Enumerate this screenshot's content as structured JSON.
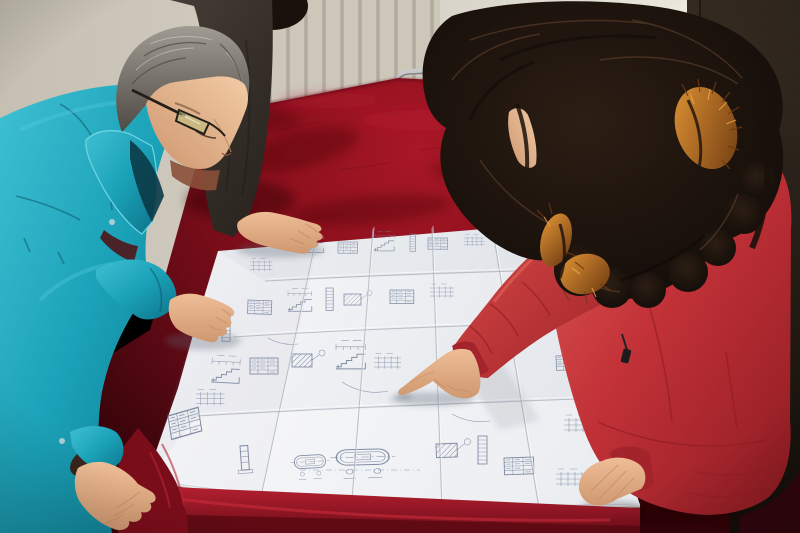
{
  "meta": {
    "type": "photograph",
    "description": "Three people lean over a large folded engineering blueprint spread on a table draped with worn dark-red velvet. A middle-aged man with gray hair and dark-rimmed glasses in a teal work jacket studies the drawing with both hands on it; a colleague in a dark jacket rests one hand on the sheet; a woman with long dark wavy hair, wearing a red hooded down coat with orange fur trim, points at a detail with her right index finger.",
    "setting": "indoor room with aged off-white wall, vertical-fin radiator, chrome tube chair behind the table and a dark doorway at the right edge"
  },
  "people": [
    {
      "id": "worker-teal",
      "position": "left",
      "appearance": "middle-aged man, gray hair, dark-rimmed glasses",
      "clothing": "teal work jacket with snap buttons and tall collar",
      "action": "leaning over the drawing, right hand on the sheet, left hand on the table corner"
    },
    {
      "id": "colleague-dark",
      "position": "upper-left background, mostly hidden",
      "appearance": "black hair, only head top and arm visible",
      "clothing": "dark brown-gray jacket",
      "action": "hand resting on the top edge of the drawing"
    },
    {
      "id": "woman-red",
      "position": "right, seen from behind-above",
      "appearance": "long dark wavy hair, sliver of face profile visible",
      "clothing": "red hooded down parka with orange fur-trimmed hood and black zipper pull",
      "action": "pointing at the blueprint with right index finger, left hand resting on the sheet"
    }
  ],
  "objects": {
    "blueprint": {
      "kind": "large folded technical drawing sheet",
      "paper_color": "white",
      "line_color": "blue-gray",
      "content": "stair section details, dimension chains, data tables, slotted flange details, ladder strips, hatched details, leader balloons; annotations too small to read",
      "folds": "grid of vertical and horizontal creases from being folded"
    },
    "table": {
      "covering": "dark red velvet cloth",
      "condition": "worn and mottled, bright fold along front edge, draped corner at lower left"
    },
    "chair": {
      "kind": "metal tube frame chair",
      "finish": "chrome",
      "location": "behind the table, partly hidden"
    },
    "radiator": {
      "kind": "vertical-fin wall radiator",
      "location": "upper left wall area"
    },
    "wall": {
      "color": "aged off-white",
      "details": "rust stain streak near top center"
    },
    "door": {
      "kind": "dark doorway / dark panel",
      "location": "right edge",
      "detail": "small hinge plate"
    }
  },
  "colors": {
    "wall-left": "#c6c0b3",
    "wall-mid": "#d9d4c9",
    "wall-right": "#eae6db",
    "door-frame": "#efebe0",
    "door-top": "#352b21",
    "door-bottom": "#140f0a",
    "radiator-panel": "#cdc7ba",
    "radiator-line": "#b1ab9e",
    "rust": "#7c4318",
    "chrome": "#c9c9c9",
    "chrome-shadow": "#6f6f6f",
    "velvet-bright": "#a81726",
    "velvet-mid": "#8a0f1c",
    "velvet-dark": "#5e0a15",
    "velvet-deep": "#360409",
    "fold-bright": "#b52030",
    "fold-dark": "#6e0d19",
    "paper-light": "#f5f6f8",
    "paper-shade": "#dde1e7",
    "blueprint-line": "#76829c",
    "crease": "#aab0ba",
    "teal-light": "#3fc0d3",
    "teal": "#1ba2b8",
    "teal-dark": "#0d7389",
    "teal-deep": "#0a4f60",
    "inner-shirt": "#4a2328",
    "dark-jacket": "#4a423a",
    "dark-jacket-deep": "#27211c",
    "hair-gray-light": "#a09c93",
    "hair-gray-dark": "#4e4a44",
    "skin-light": "#f0c59e",
    "skin-mid": "#e3ad85",
    "skin-shadow": "#c08a64",
    "skin-deep": "#8a5038",
    "coat-light": "#de5c55",
    "coat-mid": "#c23238",
    "coat-dark": "#8e1b22",
    "fur-light": "#e09434",
    "fur-dark": "#6e3a12",
    "hair-black": "#19110b",
    "hair-brown": "#6b4a32",
    "glasses": "#241e18"
  }
}
